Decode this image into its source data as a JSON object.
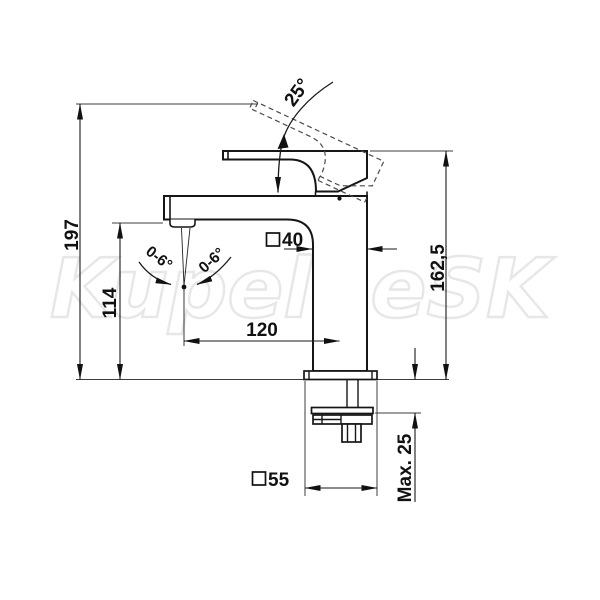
{
  "page": {
    "background": "#ffffff",
    "line_color": "#161616",
    "watermark_color": "#e7e7e7"
  },
  "watermark": {
    "text": "KupelneSK"
  },
  "drawing": {
    "subject": "single-lever-basin-mixer-technical-drawing",
    "labels": {
      "total_height": "197",
      "outlet_height": "114",
      "fixture_height": "162,5",
      "spout_reach": "120",
      "body_square_width": "40",
      "base_square_width": "55",
      "max_deck_thickness": "Max. 25",
      "lever_opening_angle": "25°",
      "spray_angle_left": "0-6°",
      "spray_angle_right": "0-6°"
    }
  }
}
